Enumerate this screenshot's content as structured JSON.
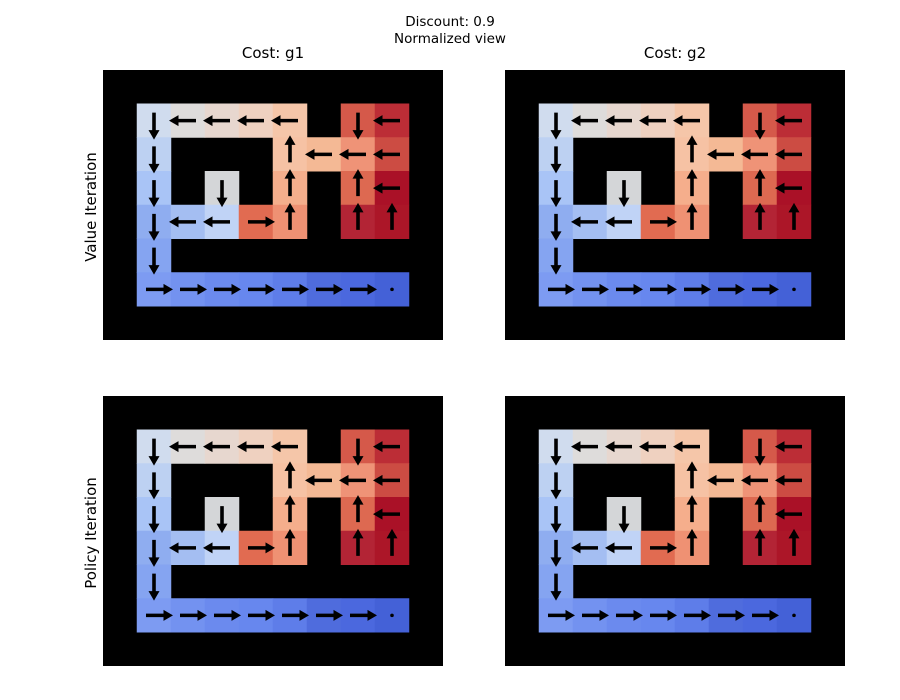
{
  "figure": {
    "background": "#ffffff",
    "suptitle": {
      "line1": "Discount: 0.9",
      "line2": "Normalized view"
    }
  },
  "chart_data": {
    "type": "heatmap",
    "subtype": "gridworld-value-function-with-policy-quiver",
    "title": "Discount: 0.9 / Normalized view",
    "col_titles": [
      "Cost: g1",
      "Cost: g2"
    ],
    "row_labels": [
      "Value Iteration",
      "Policy Iteration"
    ],
    "colormap": "coolwarm",
    "wall_color": "#000000",
    "arrow_color": "#000000",
    "grid_rows": 8,
    "grid_cols": 10,
    "panels": [
      {
        "row_label": "Value Iteration",
        "col_title": "Cost: g1"
      },
      {
        "row_label": "Value Iteration",
        "col_title": "Cost: g2"
      },
      {
        "row_label": "Policy Iteration",
        "col_title": "Cost: g1"
      },
      {
        "row_label": "Policy Iteration",
        "col_title": "Cost: g2"
      }
    ],
    "goal": {
      "r": 6,
      "c": 8
    },
    "cells": [
      {
        "r": 1,
        "c": 1,
        "color": "#d0dcee",
        "policy": "down"
      },
      {
        "r": 1,
        "c": 2,
        "color": "#dedcdb",
        "policy": "left"
      },
      {
        "r": 1,
        "c": 3,
        "color": "#e7d7cf",
        "policy": "left"
      },
      {
        "r": 1,
        "c": 4,
        "color": "#efd1c0",
        "policy": "left"
      },
      {
        "r": 1,
        "c": 5,
        "color": "#f5c6a9",
        "policy": "left"
      },
      {
        "r": 1,
        "c": 7,
        "color": "#d5594a",
        "policy": "down"
      },
      {
        "r": 1,
        "c": 8,
        "color": "#bc2d36",
        "policy": "left"
      },
      {
        "r": 2,
        "c": 1,
        "color": "#bdd1f2",
        "policy": "down"
      },
      {
        "r": 2,
        "c": 5,
        "color": "#f6c2a4",
        "policy": "up"
      },
      {
        "r": 2,
        "c": 6,
        "color": "#f4b995",
        "policy": "left"
      },
      {
        "r": 2,
        "c": 7,
        "color": "#ef9377",
        "policy": "left"
      },
      {
        "r": 2,
        "c": 8,
        "color": "#cc4c43",
        "policy": "left"
      },
      {
        "r": 3,
        "c": 1,
        "color": "#a9c4f6",
        "policy": "down"
      },
      {
        "r": 3,
        "c": 3,
        "color": "#d4d6d8",
        "policy": "down"
      },
      {
        "r": 3,
        "c": 5,
        "color": "#f5ae8c",
        "policy": "up"
      },
      {
        "r": 3,
        "c": 7,
        "color": "#dd6951",
        "policy": "up"
      },
      {
        "r": 3,
        "c": 8,
        "color": "#aa1127",
        "policy": "left"
      },
      {
        "r": 4,
        "c": 1,
        "color": "#8fadf0",
        "policy": "down"
      },
      {
        "r": 4,
        "c": 2,
        "color": "#a4bef2",
        "policy": "left"
      },
      {
        "r": 4,
        "c": 3,
        "color": "#c0d3f6",
        "policy": "left"
      },
      {
        "r": 4,
        "c": 4,
        "color": "#e16b51",
        "policy": "right"
      },
      {
        "r": 4,
        "c": 5,
        "color": "#ef9173",
        "policy": "up"
      },
      {
        "r": 4,
        "c": 7,
        "color": "#b32435",
        "policy": "up"
      },
      {
        "r": 4,
        "c": 8,
        "color": "#ac1628",
        "policy": "up"
      },
      {
        "r": 5,
        "c": 1,
        "color": "#85a4f1",
        "policy": "down"
      },
      {
        "r": 6,
        "c": 1,
        "color": "#7d9bf2",
        "policy": "right"
      },
      {
        "r": 6,
        "c": 2,
        "color": "#7392f0",
        "policy": "right"
      },
      {
        "r": 6,
        "c": 3,
        "color": "#6b8aee",
        "policy": "right"
      },
      {
        "r": 6,
        "c": 4,
        "color": "#6787ee",
        "policy": "right"
      },
      {
        "r": 6,
        "c": 5,
        "color": "#5e7de9",
        "policy": "right"
      },
      {
        "r": 6,
        "c": 6,
        "color": "#4f6cdd",
        "policy": "right"
      },
      {
        "r": 6,
        "c": 7,
        "color": "#4b68de",
        "policy": "right"
      },
      {
        "r": 6,
        "c": 8,
        "color": "#4461d7",
        "policy": "dot"
      }
    ]
  }
}
